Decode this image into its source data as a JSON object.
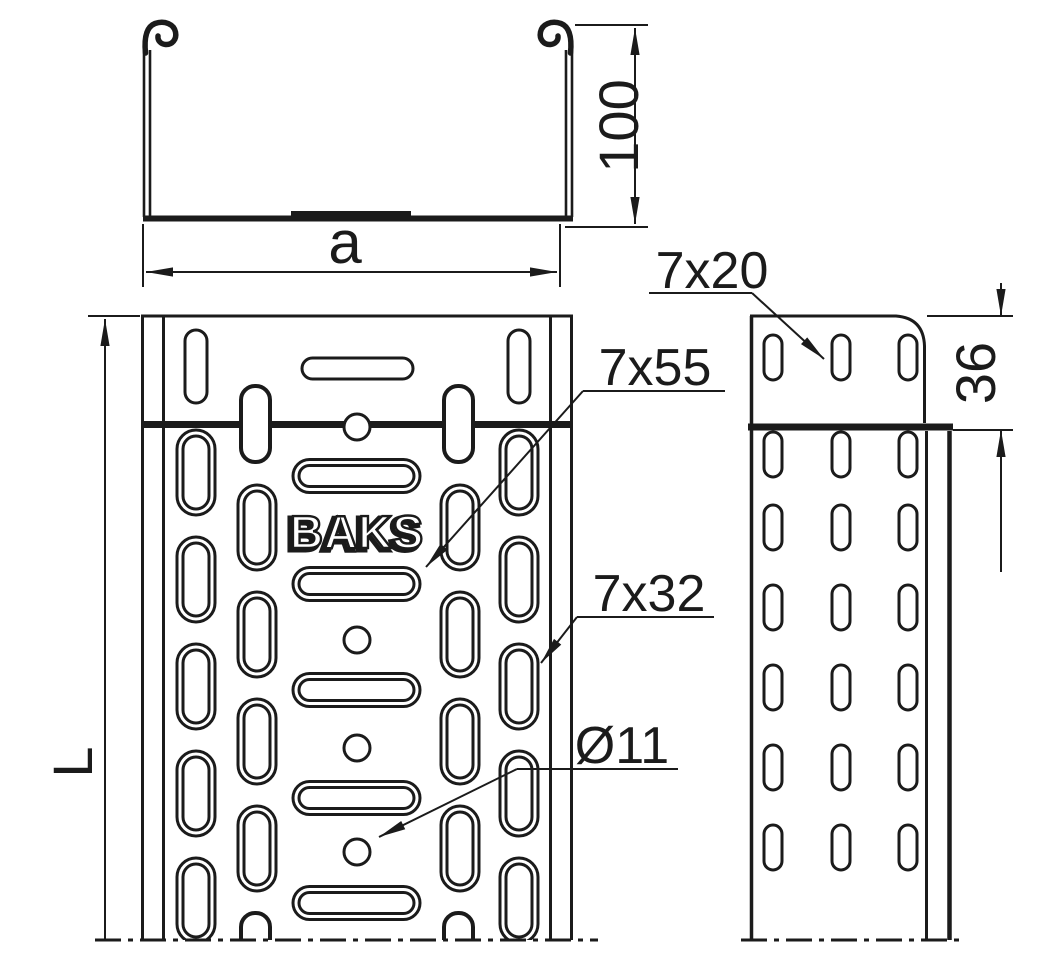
{
  "colors": {
    "ink": "#1b1b1b",
    "paper": "#ffffff"
  },
  "views": {
    "cross_section": {
      "dim_height": "100",
      "dim_width": "a"
    },
    "plan": {
      "dim_length": "L",
      "logo": "BAKS"
    },
    "side": {
      "dim_connector_height": "36"
    }
  },
  "callouts": {
    "slot_7x20": "7x20",
    "slot_7x55": "7x55",
    "slot_7x32": "7x32",
    "hole_diameter": "Ø11"
  }
}
